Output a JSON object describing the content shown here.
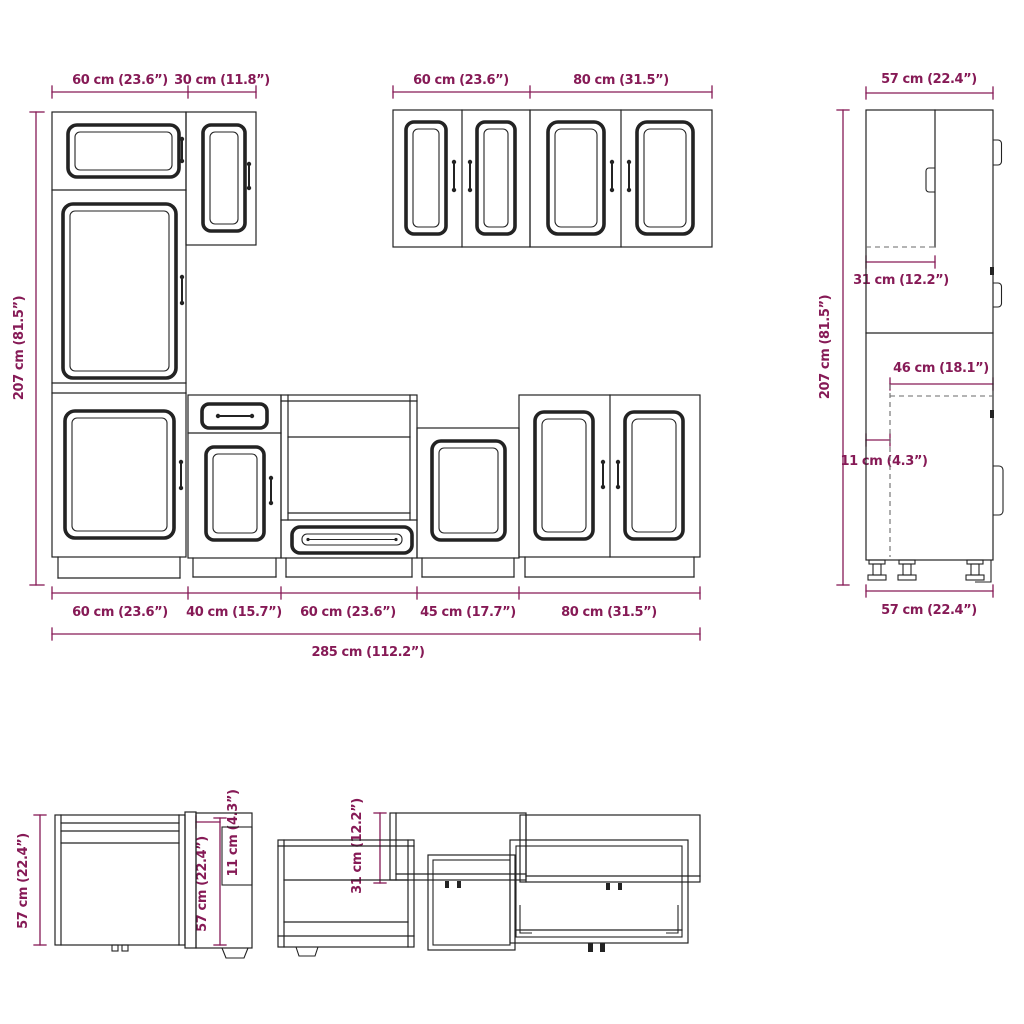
{
  "title": "Kitchen cabinet set dimension diagram",
  "colors": {
    "accent": "#861a56",
    "line": "#232323",
    "dashed": "#6a6a6a",
    "background": "#ffffff"
  },
  "front_view": {
    "wall_dims": [
      "60 cm (23.6”)",
      "30 cm (11.8”)",
      "60 cm (23.6”)",
      "80 cm (31.5”)"
    ],
    "height_dim": "207 cm (81.5”)",
    "base_dims": [
      "60 cm (23.6”)",
      "40 cm (15.7”)",
      "60 cm (23.6”)",
      "45 cm (17.7”)",
      "80 cm (31.5”)"
    ],
    "total_dim": "285 cm (112.2”)"
  },
  "side_view": {
    "width_dim": "57 cm (22.4”)",
    "height_dim": "207 cm (81.5”)",
    "upper_depth_dim": "31 cm (12.2”)",
    "counter_depth_dim": "46 cm (18.1”)",
    "toe_inset_dim": "11 cm (4.3”)",
    "bottom_width_dim": "57 cm (22.4”)"
  },
  "plan_view": {
    "left_depth_dim": "57 cm (22.4”)",
    "unit_depth_dim": "57 cm (22.4”)",
    "toe_inset_dim": "11 cm (4.3”)",
    "wall_depth_dim": "31 cm (12.2”)"
  }
}
